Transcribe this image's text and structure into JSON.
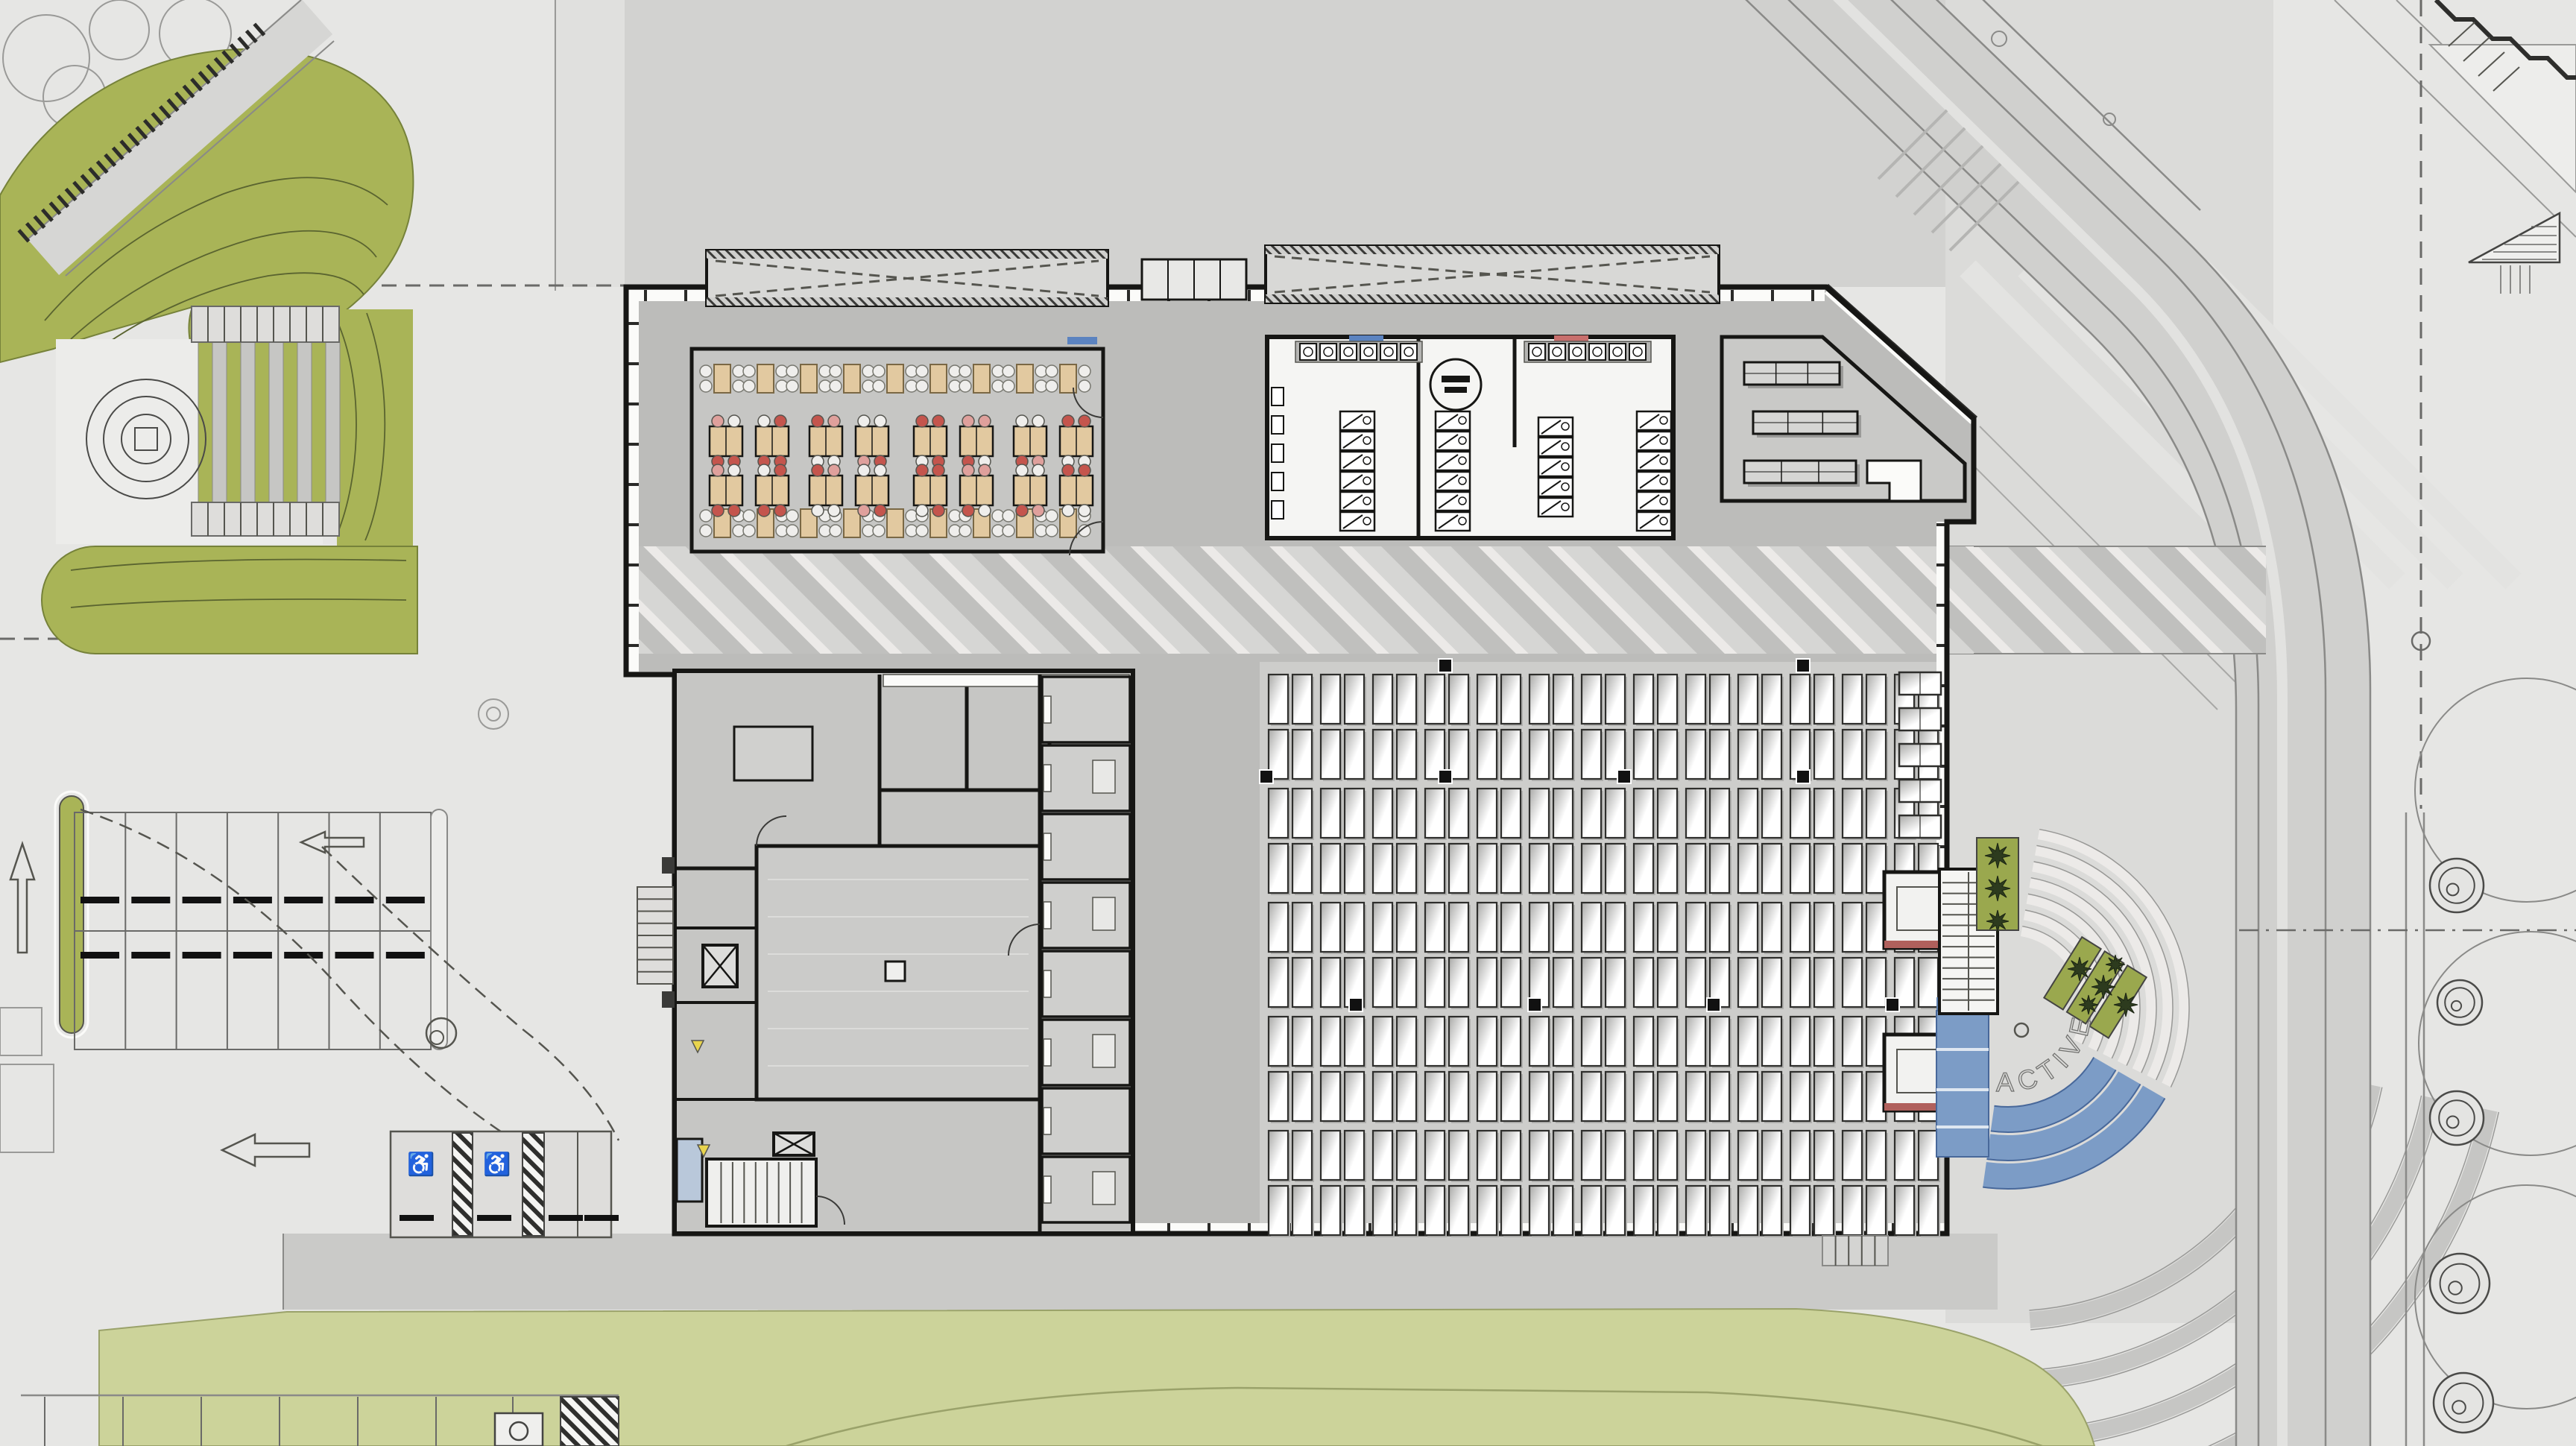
{
  "labels": {
    "amphitheater_text": "ACTIVE"
  },
  "icons": {
    "accessible-icon": "♿"
  },
  "palette": {
    "bg": "#e6e6e4",
    "plaza_top": "#d2d2d0",
    "plaza_right": "#dbdbd9",
    "plaza_left": "#e0e0de",
    "concourse": "#bcbcba",
    "dining_floor": "#c6c6c4",
    "market_floor": "#cdcdcb",
    "wing_floor": "#c9c9c7",
    "boh_floor": "#c6c6c4",
    "room_white": "#f5f5f3",
    "wall": "#161614",
    "line_dark": "#3a3a38",
    "line_mid": "#8a8a88",
    "line_light": "#b5b5b3",
    "stripe_dark": "#c0c0be",
    "stripe_light": "#eceae8",
    "green": "#a9b457",
    "green_dark": "#76823a",
    "green_line": "#5a6430",
    "lawn": "#ccd39a",
    "blue_steps": "#7c9cc6",
    "blue_dark": "#5d7fae",
    "light_blue_room": "#b9c8da",
    "table_tan": "#e2c9a0",
    "tan_dark": "#7a6845",
    "chair_red": "#c4554d",
    "chair_pink": "#dfa09c",
    "chair_white": "#efeeec",
    "road_fill": "#d0d0ce",
    "road_median": "#e2e2e0",
    "canopy_fill": "#d8d8d6",
    "accent_marker_blue": "#5b83c0",
    "accent_marker_red": "#c86f6d",
    "kiosk_red": "#b0605c",
    "equipment_yellow": "#e8d44d"
  },
  "counts": {
    "dining": {
      "small_rows": 2,
      "small_tables_per_row": 9,
      "large_rows": 2,
      "large_groups_per_row": 8
    },
    "market": {
      "bands": 5,
      "pairs_per_band": 13,
      "rows_per_band": 2
    },
    "restroom": {
      "sink_banks": 2,
      "sinks_per_bank": 6,
      "stall_banks": 4,
      "stalls_per_bank": 6
    },
    "wing_benches": 3,
    "east_benches": 5,
    "parking": {
      "rows": 2,
      "spaces_per_row": 7,
      "accessible_spaces": 2
    },
    "amphitheater": {
      "white_steps": 7,
      "blue_steps": 3
    },
    "street_trees": 5
  },
  "chair_colors": {
    "top": [
      "#dfa09c",
      "#efeeec",
      "#c4554d",
      "#efeeec",
      "#c4554d",
      "#dfa09c",
      "#efeeec",
      "#c4554d"
    ],
    "bottom": [
      "#c4554d",
      "#c4554d",
      "#efeeec",
      "#dfa09c",
      "#efeeec",
      "#c4554d",
      "#c4554d",
      "#efeeec"
    ]
  }
}
